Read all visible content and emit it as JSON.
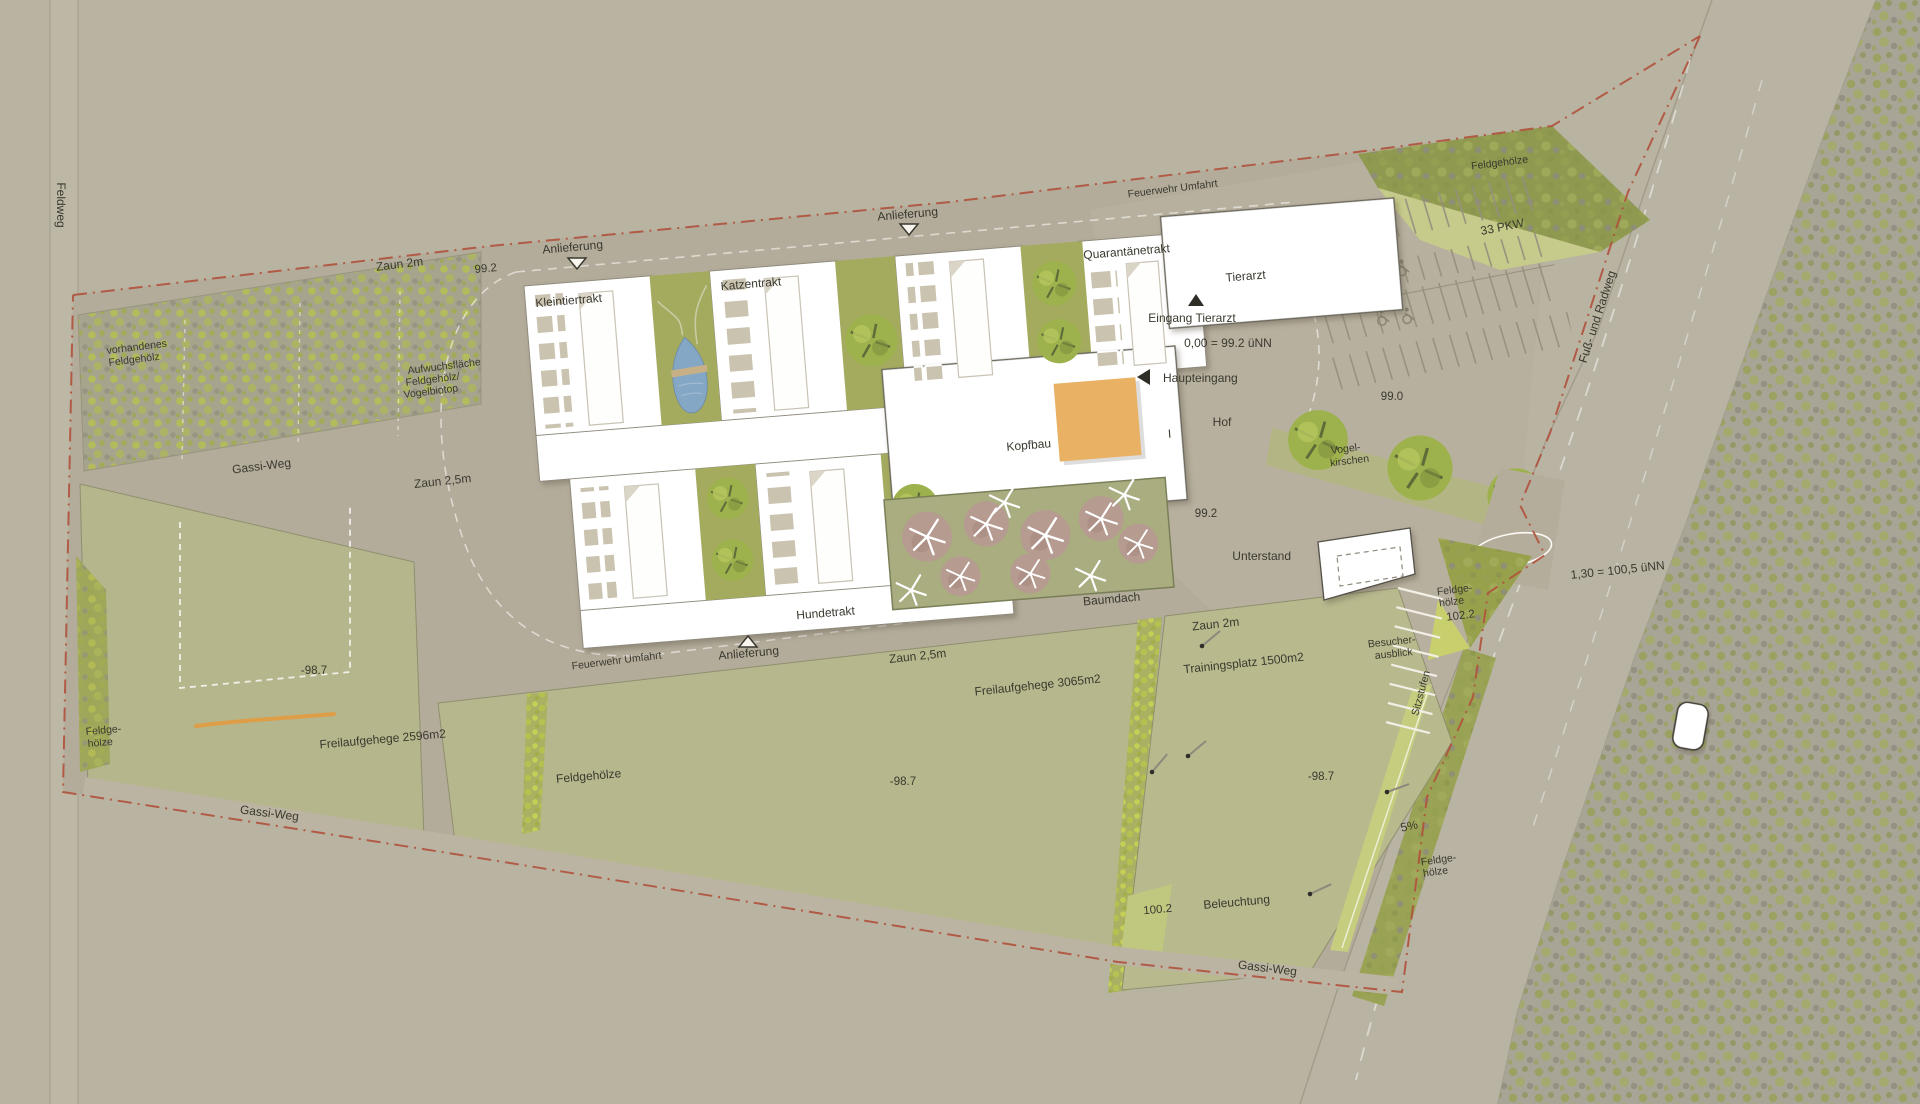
{
  "colors": {
    "background": "#b9b3a2",
    "site_ground": "#b3ac9a",
    "road_light": "#bcb6a5",
    "field_green": "#b6b78c",
    "courtyard_green": "#a4ab5f",
    "hedge_bright": "#c2cd54",
    "building_white": "#ffffff",
    "kennel_beige": "#cac3af",
    "pond_blue": "#84a7c6",
    "atrium_orange": "#e9b164",
    "canopy_rose": "#b69b90",
    "boundary_red": "#b0513c",
    "label_ink": "#3a392f"
  },
  "labels": {
    "feldweg": "Feldweg",
    "zaun_2m_nw": "Zaun 2m",
    "elev_99_2_nw": "99.2",
    "anlieferung_west": "Anlieferung",
    "kleintiertrakt": "Kleintiertrakt",
    "katzentrakt": "Katzentrakt",
    "anlieferung_mitte": "Anlieferung",
    "quarantaenetrakt": "Quarantänetrakt",
    "feuerwehr_umfahrt_nord": "Feuerwehr Umfahrt",
    "tierarzt": "Tierarzt",
    "feldgehoelze_nordost": "Feldgehölze",
    "stellplaetze": "33 PKW",
    "fuss_und_radweg": "Fuß- und Radweg",
    "eingang_tierarzt": "Eingang Tierarzt",
    "hoehe_null": "0,00 = 99.2 üNN",
    "haupteingang": "Haupteingang",
    "hof": "Hof",
    "elev_99_0": "99.0",
    "vogelkirschen_zeile1": "Vogel-",
    "vogelkirschen_zeile2": "kirschen",
    "vorhandenes_zeile1": "vorhandenes",
    "vorhandenes_zeile2": "Feldgehölz",
    "aufwuchs_zeile1": "Aufwuchsfläche",
    "aufwuchs_zeile2": "Feldgehölz/",
    "aufwuchs_zeile3": "Vogelbiotop",
    "gassi_weg_nord": "Gassi-Weg",
    "zaun_25_west": "Zaun 2,5m",
    "kopfbau": "Kopfbau",
    "schnittmarke": "I",
    "baumdach": "Baumdach",
    "elev_99_2_hof": "99.2",
    "unterstand": "Unterstand",
    "feldgehoelze_ost_zeile1": "Feldge-",
    "feldgehoelze_ost_zeile2": "hölze",
    "elev_102_2": "102.2",
    "hoehe_strasse": "1,30 = 100,5 üNN",
    "hundetrakt": "Hundetrakt",
    "feuerwehr_umfahrt_sued": "Feuerwehr Umfahrt",
    "anlieferung_sued": "Anlieferung",
    "zaun_25_sued": "Zaun 2,5m",
    "freilaufgehege_3065": "Freilaufgehege 3065m2",
    "trainingsplatz": "Trainingsplatz 1500m2",
    "zaun_2m_ost": "Zaun 2m",
    "besucherausblick_zeile1": "Besucher-",
    "besucherausblick_zeile2": "ausblick",
    "sitzstufen": "Sitzstufen",
    "elev_98_7_west": "-98.7",
    "freilaufgehege_2596": "Freilaufgehege 2596m2",
    "feldgehoelze_west_zeile1": "Feldge-",
    "feldgehoelze_west_zeile2": "hölze",
    "gassi_weg_suedwest": "Gassi-Weg",
    "feldgehoelze_mitte": "Feldgehölze",
    "elev_98_7_mitte": "-98.7",
    "elev_98_7_ost": "-98.7",
    "gefaelle": "5%",
    "feldgehoelze_suedost_zeile1": "Feldge-",
    "feldgehoelze_suedost_zeile2": "hölze",
    "elev_100_2": "100.2",
    "beleuchtung": "Beleuchtung",
    "gassi_weg_sued": "Gassi-Weg"
  }
}
